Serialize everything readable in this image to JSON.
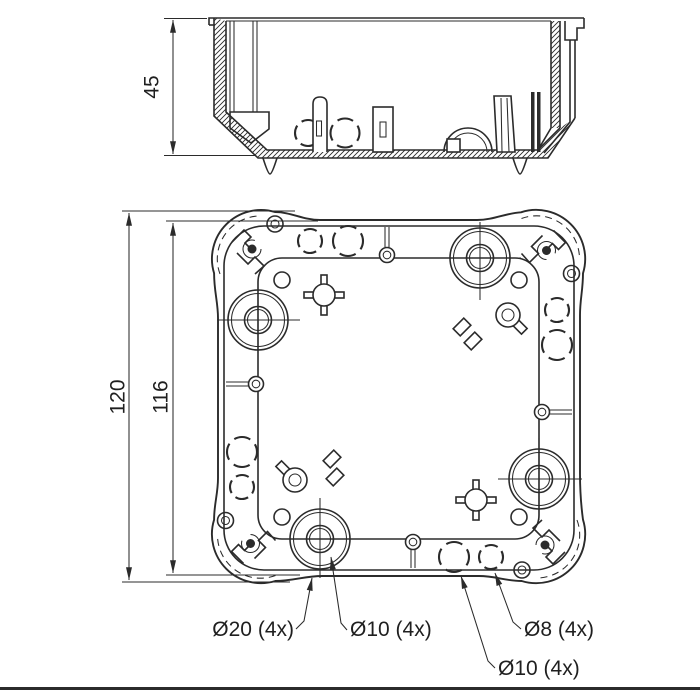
{
  "page": {
    "background": "#ffffff",
    "line_color": "#2b2b2b"
  },
  "section_view": {
    "depth_dimension": "45"
  },
  "plan_view": {
    "overall_dimension": "120",
    "face_dimension": "116",
    "callouts": {
      "large_knockouts": "Ø20 (4x)",
      "large_knockout_pilots": "Ø10 (4x)",
      "side_knockouts_small": "Ø8 (4x)",
      "side_knockouts_large": "Ø10 (4x)"
    }
  }
}
